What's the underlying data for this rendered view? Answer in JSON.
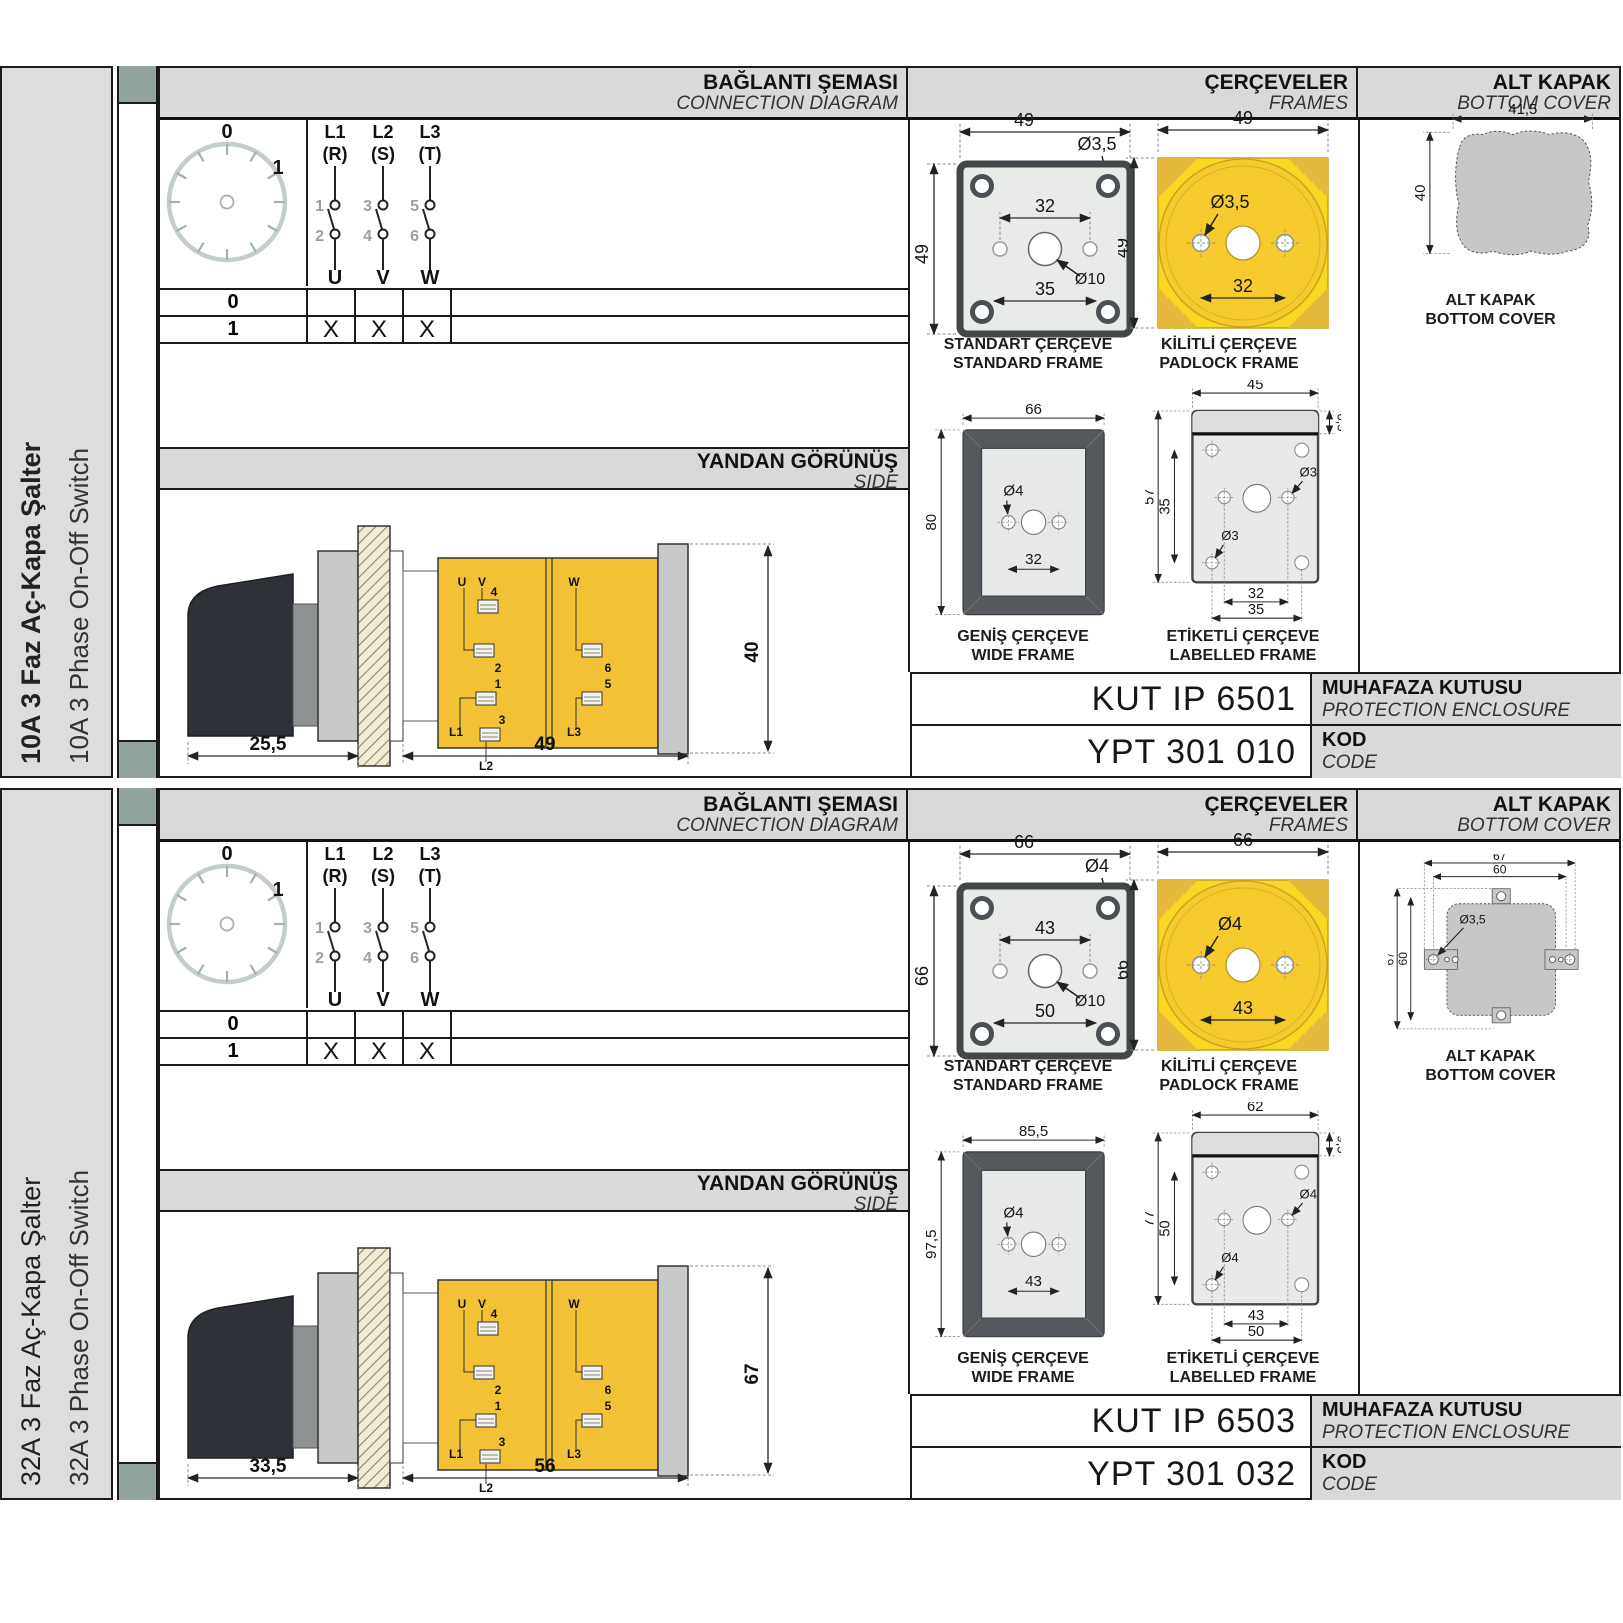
{
  "colors": {
    "frame_yellow": "#f8d825",
    "body_yellow": "#f2c136",
    "tab_green": "#93a39e",
    "header_gray": "#d8d9d8",
    "sidebar_gray": "#dcdddc"
  },
  "sections": [
    {
      "sidebar": {
        "title_tr": "10A 3 Faz Aç-Kapa Şalter",
        "title_en": "10A 3 Phase On-Off Switch"
      },
      "headers": {
        "connection_tr": "BAĞLANTI ŞEMASI",
        "connection_en": "CONNECTION DIAGRAM",
        "frames_tr": "ÇERÇEVELER",
        "frames_en": "FRAMES",
        "cover_tr": "ALT KAPAK",
        "cover_en": "BOTTOM COVER",
        "side_tr": "YANDAN GÖRÜNÜŞ",
        "side_en": "SIDE"
      },
      "diagram": {
        "dial": {
          "pos_off": "0",
          "pos_on": "1"
        },
        "phases": [
          {
            "line": "L1",
            "alt": "(R)",
            "top_contact": "1",
            "bottom_contact": "2",
            "terminal": "U"
          },
          {
            "line": "L2",
            "alt": "(S)",
            "top_contact": "3",
            "bottom_contact": "4",
            "terminal": "V"
          },
          {
            "line": "L3",
            "alt": "(T)",
            "top_contact": "5",
            "bottom_contact": "6",
            "terminal": "W"
          }
        ],
        "table": {
          "rows": [
            {
              "pos": "0",
              "u": "",
              "v": "",
              "w": ""
            },
            {
              "pos": "1",
              "u": "X",
              "v": "X",
              "w": "X"
            }
          ]
        }
      },
      "side_view": {
        "dims": {
          "handle_depth": "25,5",
          "body_depth": "49",
          "height": "40"
        },
        "labels": {
          "u": "U",
          "v": "V",
          "w": "W",
          "t1": "1",
          "t2": "2",
          "t3": "3",
          "t4": "4",
          "t5": "5",
          "t6": "6",
          "l1": "L1",
          "l2": "L2",
          "l3": "L3"
        }
      },
      "frames": {
        "standard": {
          "label_tr": "STANDART ÇERÇEVE",
          "label_en": "STANDARD FRAME",
          "width": "49",
          "height": "49",
          "screw_hole": "Ø3,5",
          "inner_spacing": "32",
          "outer_spacing": "35",
          "shaft_hole": "Ø10"
        },
        "padlock": {
          "label_tr": "KİLİTLİ ÇERÇEVE",
          "label_en": "PADLOCK FRAME",
          "width": "49",
          "height": "49",
          "screw_hole": "Ø3,5",
          "hole_spacing": "32"
        },
        "wide": {
          "label_tr": "GENİŞ ÇERÇEVE",
          "label_en": "WIDE FRAME",
          "width": "66",
          "height": "80",
          "screw_hole": "Ø4",
          "hole_spacing": "32"
        },
        "labelled": {
          "label_tr": "ETİKETLİ ÇERÇEVE",
          "label_en": "LABELLED FRAME",
          "width": "45",
          "band_height": "6,5",
          "height": "57",
          "inner_height": "35",
          "hole_right": "Ø3",
          "hole_left": "Ø3",
          "inner_spacing": "32",
          "outer_spacing": "35"
        }
      },
      "bottom_cover": {
        "label_tr": "ALT KAPAK",
        "label_en": "BOTTOM COVER",
        "width": "41,5",
        "height": "40"
      },
      "codes": {
        "enclosure_code": "KUT IP 6501",
        "enclosure_tr": "MUHAFAZA KUTUSU",
        "enclosure_en": "PROTECTION ENCLOSURE",
        "code": "YPT 301 010",
        "code_tr": "KOD",
        "code_en": "CODE"
      }
    },
    {
      "sidebar": {
        "title_tr": "32A 3 Faz Aç-Kapa Şalter",
        "title_en": "32A 3 Phase On-Off Switch"
      },
      "headers": {
        "connection_tr": "BAĞLANTI ŞEMASI",
        "connection_en": "CONNECTION DIAGRAM",
        "frames_tr": "ÇERÇEVELER",
        "frames_en": "FRAMES",
        "cover_tr": "ALT KAPAK",
        "cover_en": "BOTTOM COVER",
        "side_tr": "YANDAN GÖRÜNÜŞ",
        "side_en": "SIDE"
      },
      "diagram": {
        "dial": {
          "pos_off": "0",
          "pos_on": "1"
        },
        "phases": [
          {
            "line": "L1",
            "alt": "(R)",
            "top_contact": "1",
            "bottom_contact": "2",
            "terminal": "U"
          },
          {
            "line": "L2",
            "alt": "(S)",
            "top_contact": "3",
            "bottom_contact": "4",
            "terminal": "V"
          },
          {
            "line": "L3",
            "alt": "(T)",
            "top_contact": "5",
            "bottom_contact": "6",
            "terminal": "W"
          }
        ],
        "table": {
          "rows": [
            {
              "pos": "0",
              "u": "",
              "v": "",
              "w": ""
            },
            {
              "pos": "1",
              "u": "X",
              "v": "X",
              "w": "X"
            }
          ]
        }
      },
      "side_view": {
        "dims": {
          "handle_depth": "33,5",
          "body_depth": "56",
          "height": "67"
        },
        "labels": {
          "u": "U",
          "v": "V",
          "w": "W",
          "t1": "1",
          "t2": "2",
          "t3": "3",
          "t4": "4",
          "t5": "5",
          "t6": "6",
          "l1": "L1",
          "l2": "L2",
          "l3": "L3"
        }
      },
      "frames": {
        "standard": {
          "label_tr": "STANDART ÇERÇEVE",
          "label_en": "STANDARD FRAME",
          "width": "66",
          "height": "66",
          "screw_hole": "Ø4",
          "inner_spacing": "43",
          "outer_spacing": "50",
          "shaft_hole": "Ø10"
        },
        "padlock": {
          "label_tr": "KİLİTLİ ÇERÇEVE",
          "label_en": "PADLOCK FRAME",
          "width": "66",
          "height": "66",
          "screw_hole": "Ø4",
          "hole_spacing": "43"
        },
        "wide": {
          "label_tr": "GENİŞ ÇERÇEVE",
          "label_en": "WIDE FRAME",
          "width": "85,5",
          "height": "97,5",
          "screw_hole": "Ø4",
          "hole_spacing": "43"
        },
        "labelled": {
          "label_tr": "ETİKETLİ ÇERÇEVE",
          "label_en": "LABELLED FRAME",
          "width": "62",
          "band_height": "9,5",
          "height": "77",
          "inner_height": "50",
          "hole_right": "Ø4",
          "hole_left": "Ø4",
          "inner_spacing": "43",
          "outer_spacing": "50"
        }
      },
      "bottom_cover": {
        "label_tr": "ALT KAPAK",
        "label_en": "BOTTOM COVER",
        "outer_width": "67",
        "inner_width": "60",
        "outer_height": "67",
        "inner_height": "60",
        "hole": "Ø3,5"
      },
      "codes": {
        "enclosure_code": "KUT IP 6503",
        "enclosure_tr": "MUHAFAZA KUTUSU",
        "enclosure_en": "PROTECTION ENCLOSURE",
        "code": "YPT 301 032",
        "code_tr": "KOD",
        "code_en": "CODE"
      }
    }
  ]
}
